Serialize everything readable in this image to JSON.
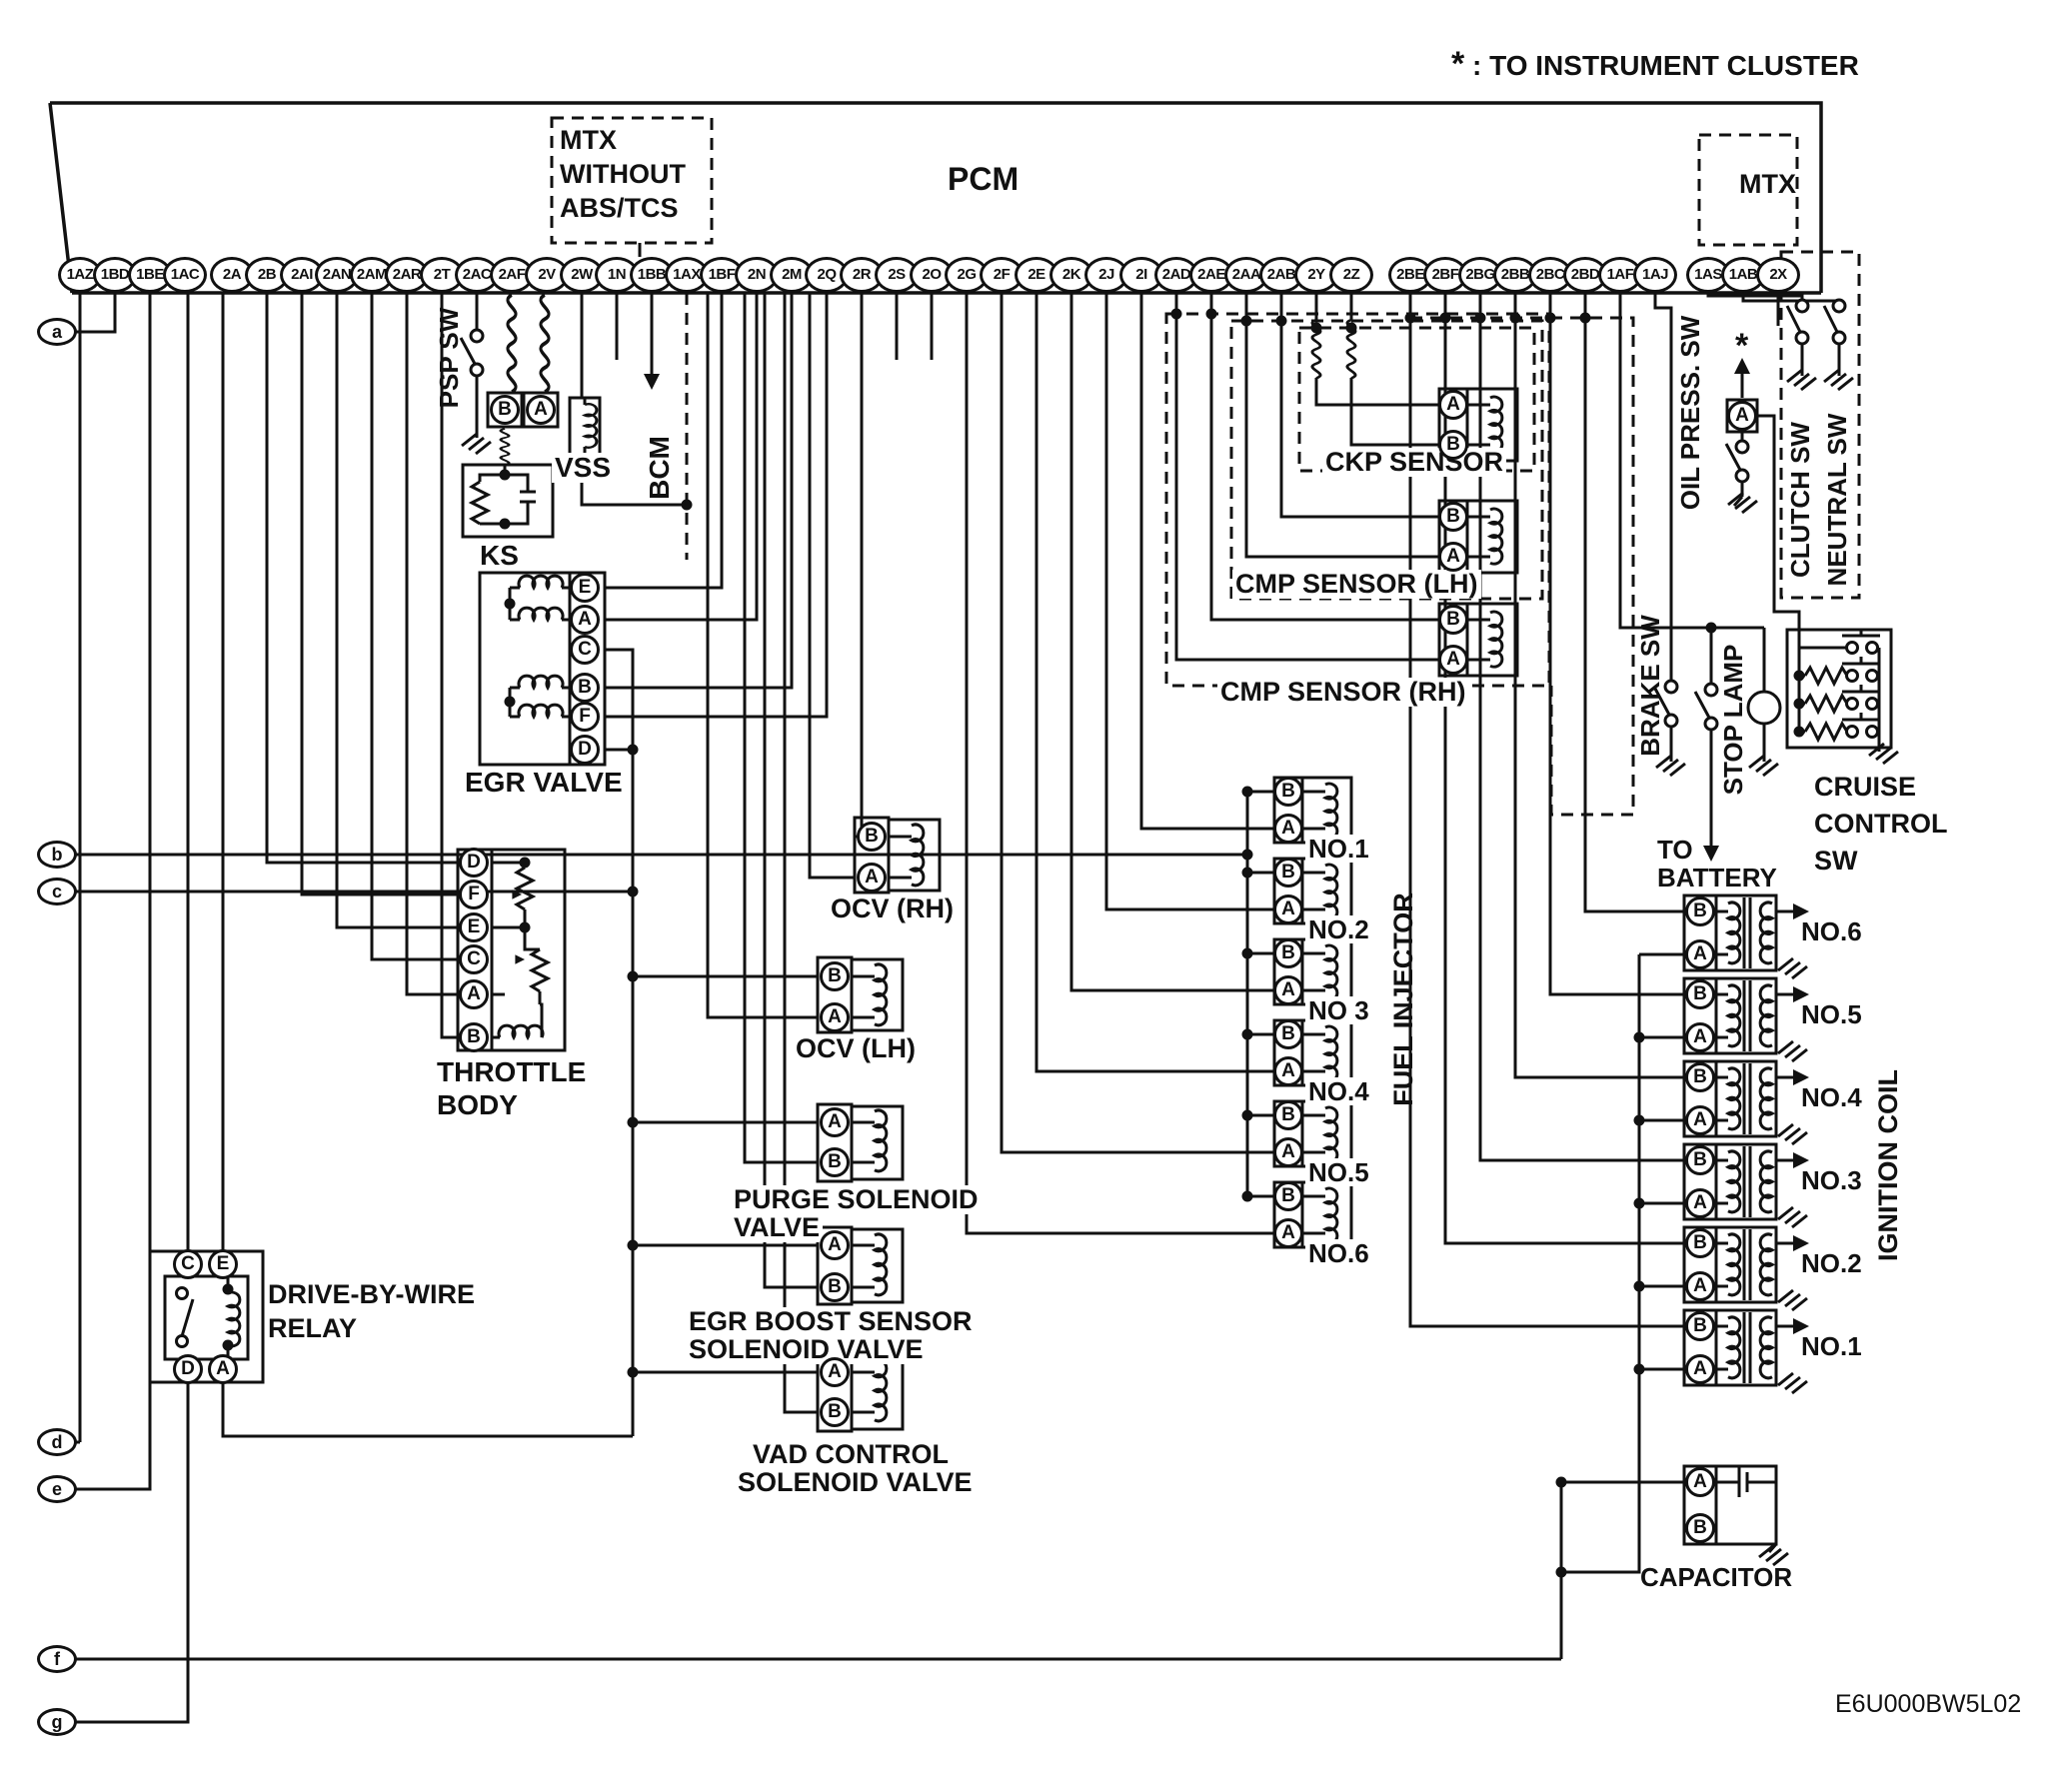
{
  "note": {
    "star": "*",
    "text": ": TO INSTRUMENT CLUSTER"
  },
  "pcm": {
    "label": "PCM",
    "pins": [
      "1AZ",
      "1BD",
      "1BE",
      "1AC",
      "2A",
      "2B",
      "2AI",
      "2AN",
      "2AM",
      "2AR",
      "2T",
      "2AC",
      "2AF",
      "2V",
      "2W",
      "1N",
      "1BB",
      "1AX",
      "1BF",
      "2N",
      "2M",
      "2Q",
      "2R",
      "2S",
      "2O",
      "2G",
      "2F",
      "2E",
      "2K",
      "2J",
      "2I",
      "2AD",
      "2AE",
      "2AA",
      "2AB",
      "2Y",
      "2Z",
      "2BE",
      "2BF",
      "2BG",
      "2BB",
      "2BC",
      "2BD",
      "1AF",
      "1AJ",
      "1AS",
      "1AB",
      "2X"
    ]
  },
  "mtx_top": {
    "label": "MTX"
  },
  "mtx_without": {
    "line1": "MTX",
    "line2": "WITHOUT",
    "line3": "ABS/TCS"
  },
  "ports": {
    "a": "a",
    "b": "b",
    "c": "c",
    "d": "d",
    "e": "e",
    "f": "f",
    "g": "g"
  },
  "conn": {
    "ba": [
      "B",
      "A"
    ],
    "ab": [
      "A",
      "B"
    ],
    "egr": [
      "E",
      "A",
      "C",
      "B",
      "F",
      "D"
    ],
    "throttle": [
      "D",
      "F",
      "E",
      "C",
      "A",
      "B"
    ],
    "relay": [
      "C",
      "E",
      "D",
      "A"
    ],
    "a": [
      "A"
    ]
  },
  "components": {
    "psp": "PSP SW",
    "vss": "VSS",
    "bcm": "BCM",
    "ks": "KS",
    "egr": {
      "label": "EGR VALVE"
    },
    "throttle": {
      "line1": "THROTTLE",
      "line2": "BODY"
    },
    "relay": {
      "line1": "DRIVE-BY-WIRE",
      "line2": "RELAY"
    },
    "ocv_rh": {
      "label": "OCV (RH)"
    },
    "ocv_lh": {
      "label": "OCV (LH)"
    },
    "purge": {
      "line1": "PURGE SOLENOID",
      "line2": "VALVE"
    },
    "egr_boost": {
      "line1": "EGR BOOST SENSOR",
      "line2": "SOLENOID VALVE"
    },
    "vad": {
      "line1": "VAD CONTROL",
      "line2": "SOLENOID VALVE"
    },
    "ckp": {
      "label": "CKP SENSOR"
    },
    "cmp_lh": {
      "label": "CMP SENSOR (LH)"
    },
    "cmp_rh": {
      "label": "CMP SENSOR (RH)"
    },
    "injectors": {
      "label": "FUEL INJECTOR",
      "items": [
        "NO.1",
        "NO.2",
        "NO 3",
        "NO.4",
        "NO.5",
        "NO.6"
      ]
    },
    "oil": {
      "label": "OIL PRESS. SW",
      "star": "*"
    },
    "clutch": "CLUTCH SW",
    "neutral": "NEUTRAL SW",
    "brake": "BRAKE SW",
    "stop": "STOP LAMP",
    "battery": {
      "line1": "TO",
      "line2": "BATTERY"
    },
    "cruise": {
      "line1": "CRUISE",
      "line2": "CONTROL",
      "line3": "SW"
    },
    "coils": {
      "label": "IGNITION COIL",
      "items": [
        "NO.6",
        "NO.5",
        "NO.4",
        "NO.3",
        "NO.2",
        "NO.1"
      ]
    },
    "capacitor": {
      "label": "CAPACITOR"
    }
  },
  "code": "E6U000BW5L02",
  "colors": {
    "ink": "#111111",
    "bg": "#ffffff"
  }
}
